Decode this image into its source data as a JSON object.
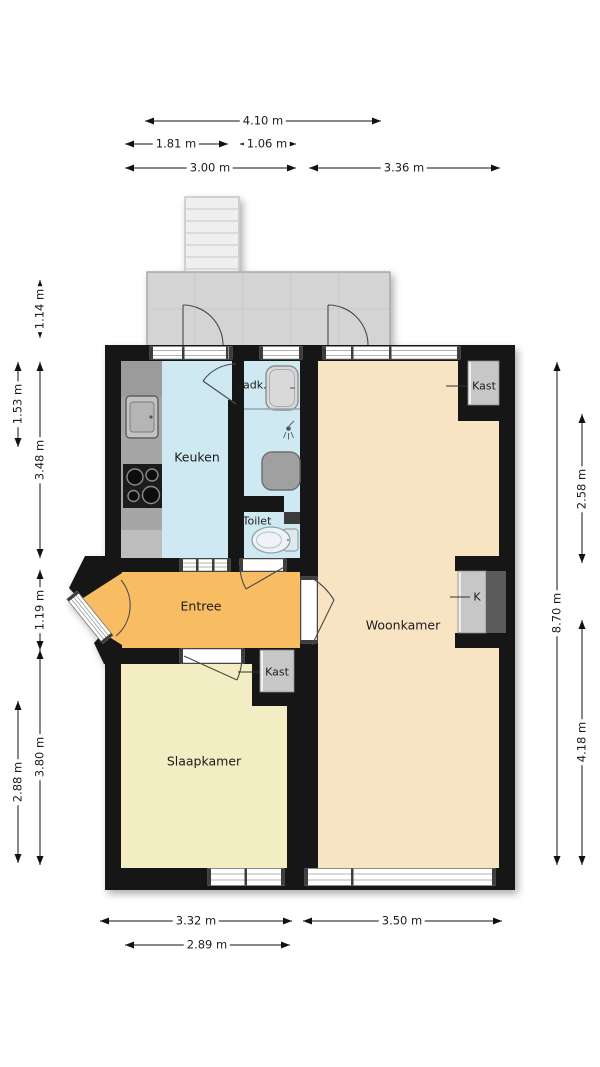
{
  "colors": {
    "wall": "#161616",
    "keuken": "#cfe9f2",
    "woonkamer": "#f8e3c3",
    "entree": "#f8bd63",
    "slaapkamer": "#f3edc3",
    "balkon": "#d4d4d4",
    "kast": "#c7c7c7",
    "kast_donker": "#5a5a5a",
    "aanrecht": "#a6a6a6"
  },
  "rooms": {
    "keuken": "Keuken",
    "badkamer": "Badk.",
    "toilet": "Toilet",
    "entree": "Entree",
    "woonkamer": "Woonkamer",
    "slaapkamer": "Slaapkamer",
    "kast_woonkamer": "Kast",
    "kast_rechts": "K",
    "kast_slaapkamer": "Kast"
  },
  "dimensions": {
    "top": [
      "4.10 m",
      "1.81 m",
      "1.06 m",
      "3.00 m",
      "3.36 m"
    ],
    "left": [
      "1.14 m",
      "1.53 m",
      "3.48 m",
      "1.19 m",
      "3.80 m",
      "2.88 m"
    ],
    "right": [
      "8.70 m",
      "2.58 m",
      "4.18 m"
    ],
    "bottom": [
      "3.32 m",
      "3.50 m",
      "2.89 m"
    ]
  }
}
